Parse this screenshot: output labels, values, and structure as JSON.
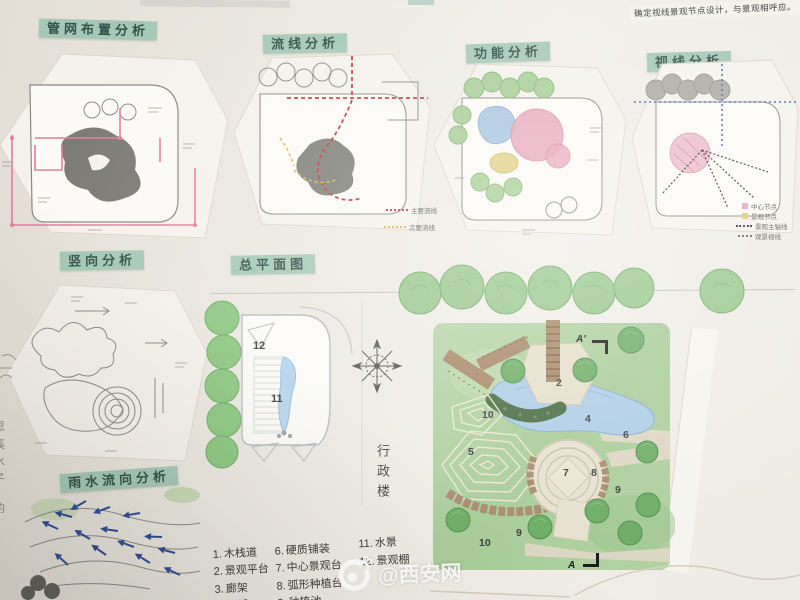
{
  "note_top": "确定视线景观节点设计，与景观相呼应。",
  "panels": {
    "pipe": {
      "title": "管网布置分析"
    },
    "flow": {
      "title": "流线分析",
      "legend": [
        {
          "label": "主要流线"
        },
        {
          "label": "次要流线"
        }
      ]
    },
    "function": {
      "title": "功能分析"
    },
    "sight": {
      "title": "视线分析",
      "legend": [
        {
          "label": "中心节点"
        },
        {
          "label": "景观节点"
        },
        {
          "label": "景观主轴线"
        },
        {
          "label": "观景视线"
        }
      ]
    },
    "vertical": {
      "title": "竖向分析"
    },
    "rain": {
      "title": "雨水流向分析"
    }
  },
  "masterplan": {
    "title": "总平面图",
    "building_label": "行政楼",
    "labels": {
      "n2": "2",
      "n4": "4",
      "n5": "5",
      "n6": "6",
      "n7": "7",
      "n8": "8",
      "n9": "9",
      "n10": "10",
      "n11": "11",
      "n12": "12",
      "secA": "A",
      "secA2": "A'"
    },
    "legend": [
      {
        "no": "1.",
        "label": "木栈道"
      },
      {
        "no": "2.",
        "label": "景观平台"
      },
      {
        "no": "3.",
        "label": "廊架"
      },
      {
        "no": "4.",
        "label": "旱溪"
      },
      {
        "no": "6.",
        "label": "硬质铺装"
      },
      {
        "no": "7.",
        "label": "中心景观台"
      },
      {
        "no": "8.",
        "label": "弧形种植台"
      },
      {
        "no": "9.",
        "label": "种植池"
      },
      {
        "no": "11.",
        "label": "水景"
      },
      {
        "no": "12.",
        "label": "景观棚"
      }
    ]
  },
  "watermark": {
    "handle": "@西安网"
  },
  "edge_text": [
    "思",
    "溪",
    "水",
    "子",
    "的"
  ],
  "colors": {
    "label_bg": "#a5c8b6",
    "main_flow_red": "#c23a3a",
    "secondary_flow_yellow": "#d9b84a",
    "pipe_pink": "#e87b9b",
    "rain_arrow_blue": "#2d4a95"
  }
}
